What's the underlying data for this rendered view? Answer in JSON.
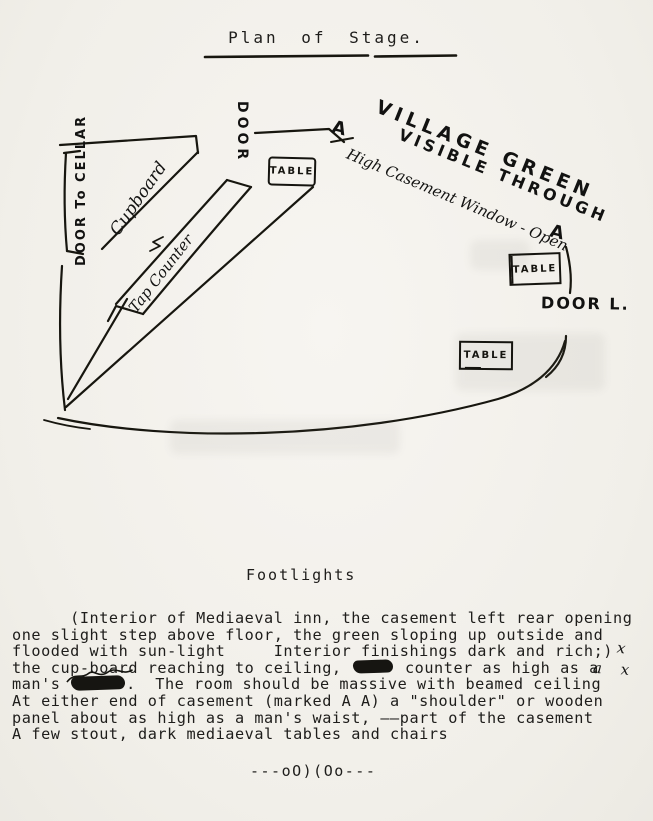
{
  "page": {
    "title": "Plan of Stage.",
    "footlights_label": "Footlights",
    "end_mark": "---oO)(Oo---",
    "ink_color": "#1c1c1c",
    "paper_color": "#f3f1ec"
  },
  "diagram": {
    "village_green_line1": "VILLAGE GREEN",
    "village_green_line2": "VISIBLE THROUGH",
    "casement_a_left": "A",
    "casement_label": "High Casement Window - Open",
    "casement_a_right": "A",
    "door_top": "DOOR",
    "door_to_cellar": "DOOR To CELLAR",
    "cupboard": "Cupboard",
    "tap_counter": "Tap Counter",
    "door_left": "DOOR L.",
    "tables": [
      "TABLE",
      "TABLE",
      "TABLE"
    ]
  },
  "paragraph": {
    "line1": "      (Interior of Mediaeval inn, the casement left rear opening",
    "line2": "one slight step above floor, the green sloping up outside and",
    "line3": "flooded with sun-light     Interior finishings dark and rich;)",
    "line4_pre": "the cup-board reaching to ceiling, ",
    "line4_post": " counter as high as a",
    "line5_pre": "man's ",
    "line5_post": ".  The room should be massive with beamed ceiling",
    "line6": "At either end of casement (marked A A) a \"shoulder\" or wooden",
    "line7": "panel about as high as a man's waist, ——part of the casement",
    "line8": "A few stout, dark mediaeval tables and chairs",
    "margin_mark_1": "x",
    "margin_mark_2": "a x"
  }
}
